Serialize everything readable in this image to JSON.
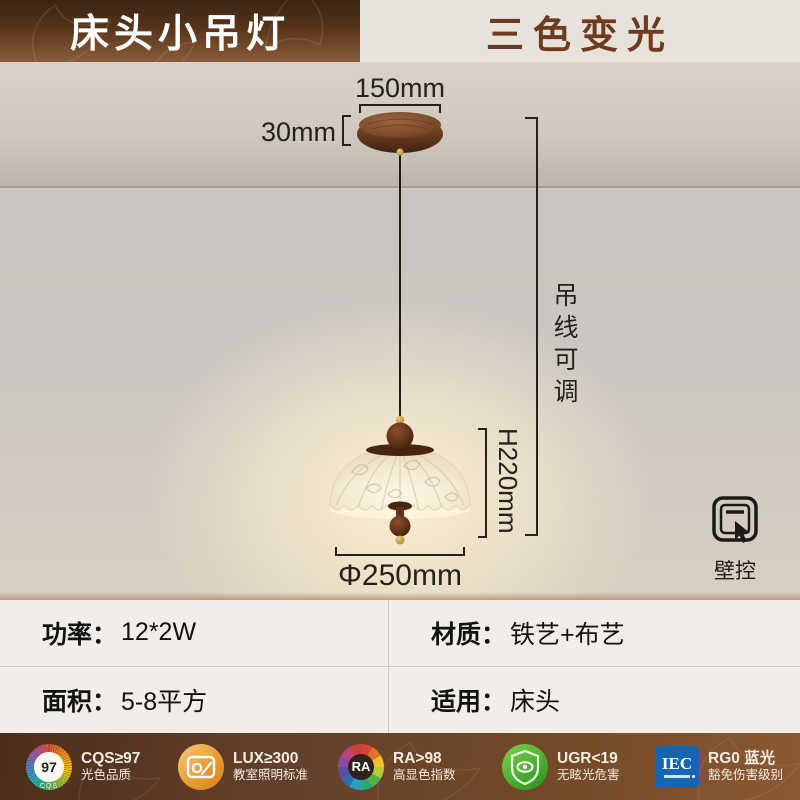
{
  "header": {
    "title": "床头小吊灯",
    "badge": "三色变光"
  },
  "diagram": {
    "canopy_width": "150mm",
    "canopy_height": "30mm",
    "wire_label": "吊线可调",
    "height_label": "H220mm",
    "diameter_label": "Φ250mm",
    "wall_control_label": "壁控"
  },
  "specs": {
    "cells": [
      {
        "label": "功率：",
        "value": "12*2W"
      },
      {
        "label": "材质：",
        "value": "铁艺+布艺"
      },
      {
        "label": "面积：",
        "value": "5-8平方"
      },
      {
        "label": "适用：",
        "value": "床头"
      }
    ]
  },
  "certifications": [
    {
      "icon": "cqs-quality-icon",
      "badge_center": "97",
      "badge_sub": "CQS",
      "line1": "CQS≥97",
      "line2": "光色品质"
    },
    {
      "icon": "classroom-lighting-icon",
      "line1": "LUX≥300",
      "line2": "教室照明标准"
    },
    {
      "icon": "color-render-wheel-icon",
      "badge_center": "RA",
      "line1": "RA>98",
      "line2": "高显色指数"
    },
    {
      "icon": "anti-glare-shield-icon",
      "line1": "UGR<19",
      "line2": "无眩光危害"
    },
    {
      "icon": "iec-cert-icon",
      "badge_center": "IEC",
      "line1": "RG0 蓝光",
      "line2": "豁免伤害级别"
    }
  ],
  "colors": {
    "header_brown_dark": "#3a2412",
    "header_brown_light": "#8a5c3a",
    "header_text": "#ffffff",
    "header_badge_text": "#6e3a21",
    "ceiling_beige": "#d3ccc1",
    "wall_gray": "#c9c5c0",
    "glow_warm": "#fdf1d6",
    "walnut_wood": "#5a3120",
    "brass_gold": "#cfa449",
    "shade_cream": "#f4ecd8",
    "spec_bg": "#f1eee9",
    "footer_brown": "#6b4226",
    "iec_blue": "#1565b5",
    "ugr_green": "#3fa42c",
    "lux_gold": "#e99b33"
  }
}
